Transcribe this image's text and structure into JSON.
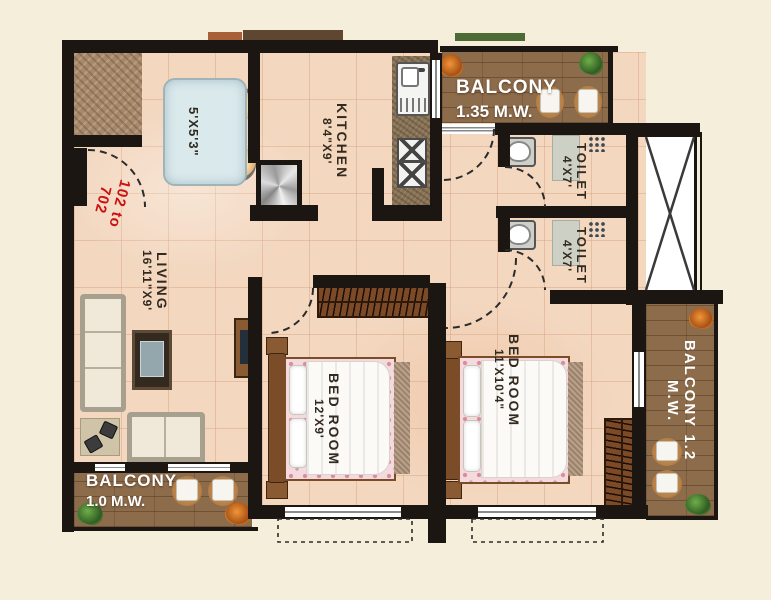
{
  "unit_label": {
    "line1": "102 to",
    "line2": "702"
  },
  "rooms": {
    "dining_table": {
      "dims": "5'X5'3\""
    },
    "kitchen": {
      "name": "KITCHEN",
      "dims": "8'4\"X9'"
    },
    "balcony_top": {
      "name": "BALCONY",
      "dims": "1.35 M.W."
    },
    "toilet_1": {
      "name": "TOILET",
      "dims": "4'X7'"
    },
    "toilet_2": {
      "name": "TOILET",
      "dims": "4'X7'"
    },
    "living": {
      "name": "LIVING",
      "dims": "16'11\"X9'"
    },
    "bedroom_1": {
      "name": "BED ROOM",
      "dims": "12'X9'"
    },
    "bedroom_2": {
      "name": "BED ROOM",
      "dims": "11'X10'4\""
    },
    "balcony_right": {
      "name": "BALCONY",
      "dims": "1.2 M.W."
    },
    "balcony_bottom": {
      "name": "BALCONY",
      "dims": "1.0 M.W."
    }
  },
  "colors": {
    "wall": "#1b1612",
    "floor": "#f3d7bf",
    "foyer": "#a8896c",
    "wood": "#8d6c4b",
    "granite": "#8a7355",
    "accent_red": "#cc1111",
    "label": "#32291f",
    "white": "#ffffff",
    "background": "#f4eedb"
  }
}
